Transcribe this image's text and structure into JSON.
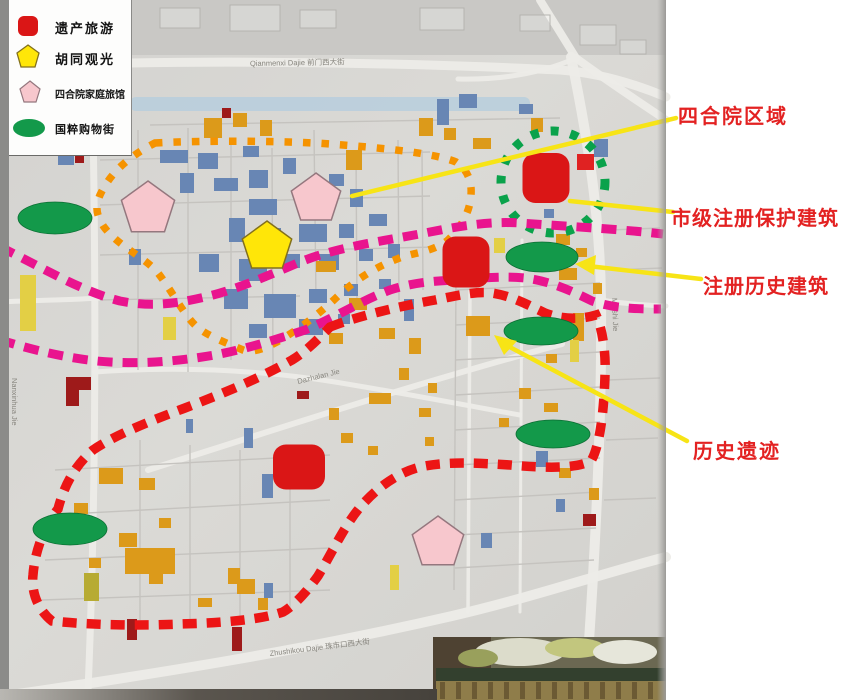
{
  "legend": {
    "items": [
      {
        "label": "遗产旅游",
        "marker": "heritage-red-square"
      },
      {
        "label": "胡同观光",
        "marker": "hutong-yellow-pentagon"
      },
      {
        "label": "四合院家庭旅馆",
        "marker": "courtyard-inn-pink-pentagon"
      },
      {
        "label": "国粹购物街",
        "marker": "shopping-green-ellipse"
      }
    ]
  },
  "colors": {
    "heritage": "#da1616",
    "hutong": "#ffe608",
    "hutong_stroke": "#82701c",
    "inn": "#f7c7cd",
    "inn_stroke": "#94777e",
    "shopping": "#13994a",
    "zone_green": "#0aa24b",
    "zone_orange": "#f59300",
    "boundary_magenta": "#e9148e",
    "route_red": "#ec1515",
    "arrow_yellow": "#f7e416",
    "label_red": "#e32222"
  },
  "annotations": [
    {
      "label": "四合院区域",
      "x": 678,
      "y": 100,
      "line": [
        352,
        196,
        676,
        118
      ]
    },
    {
      "label": "市级注册保护建筑",
      "x": 671,
      "y": 202,
      "line": [
        570,
        201,
        673,
        212
      ]
    },
    {
      "label": "注册历史建筑",
      "x": 703,
      "y": 270,
      "line": [
        588,
        266,
        701,
        279
      ],
      "arrow": [
        [
          575,
          264
        ],
        [
          596,
          255
        ],
        [
          594,
          275
        ]
      ]
    },
    {
      "label": "历史遗迹",
      "x": 693,
      "y": 435,
      "line": [
        504,
        344,
        687,
        441
      ],
      "arrow": [
        [
          494,
          335
        ],
        [
          517,
          341
        ],
        [
          504,
          355
        ]
      ]
    }
  ],
  "map": {
    "street_labels": [
      {
        "text": "Qianmenxi Dajie  前门西大街",
        "x": 250,
        "y": 66,
        "rot": -1
      },
      {
        "text": "Nanxinhua Jie",
        "x": 12,
        "y": 378,
        "rot": 90
      },
      {
        "text": "Dazhalan Jie",
        "x": 298,
        "y": 384,
        "rot": -14
      },
      {
        "text": "Meishi Jie",
        "x": 612,
        "y": 298,
        "rot": 88
      },
      {
        "text": "Zhushikou Dajie  珠市口西大街",
        "x": 270,
        "y": 656,
        "rot": -7
      }
    ],
    "markers": {
      "heritage": [
        {
          "x": 546,
          "y": 178,
          "w": 47,
          "h": 50
        },
        {
          "x": 466,
          "y": 262,
          "w": 47,
          "h": 51
        },
        {
          "x": 299,
          "y": 467,
          "w": 52,
          "h": 45
        }
      ],
      "hutong": [
        {
          "x": 267,
          "y": 247,
          "r": 26
        }
      ],
      "inns": [
        {
          "x": 148,
          "y": 209,
          "r": 28
        },
        {
          "x": 316,
          "y": 199,
          "r": 26
        },
        {
          "x": 438,
          "y": 543,
          "r": 27
        }
      ],
      "shopping": [
        {
          "x": 55,
          "y": 218,
          "rx": 37,
          "ry": 16
        },
        {
          "x": 542,
          "y": 257,
          "rx": 36,
          "ry": 15
        },
        {
          "x": 541,
          "y": 331,
          "rx": 37,
          "ry": 14
        },
        {
          "x": 553,
          "y": 434,
          "rx": 37,
          "ry": 14
        },
        {
          "x": 70,
          "y": 529,
          "rx": 37,
          "ry": 16
        }
      ]
    },
    "zones": {
      "courtyard_circle": {
        "cx": 553,
        "cy": 182,
        "rx": 52,
        "ry": 51
      },
      "orange_loop": "M155,143 C210,140 290,141 330,144 C370,147 432,152 456,162 C468,170 472,182 471,195 C470,212 461,228 447,241 C430,253 414,252 397,259 C371,269 352,283 337,297 C318,315 299,329 277,342 C262,350 250,353 243,350 C227,343 207,336 196,326 C184,315 172,291 158,273 C146,258 118,246 104,227 C96,215 95,207 100,195 C108,178 122,160 155,143 Z",
      "magenta_upper": "M0,247 C40,266 80,291 120,301 C150,307 175,304 205,297 C235,290 265,277 300,262 C340,246 390,240 430,232 C460,226 490,221 520,223 C560,226 620,229 663,234",
      "magenta_lower": "M0,340 C40,352 75,360 110,362 C145,364 180,361 215,355 C245,349 275,340 305,330 C335,318 360,301 390,290 C415,282 435,281 455,280 C480,278 505,276 525,278 C550,281 572,291 592,301 C615,309 640,309 661,309",
      "red_loop": "M330,327 C355,317 400,306 435,300 C455,296 475,291 492,293 C512,296 528,305 545,313 C560,319 580,320 596,315 C603,330 606,355 605,375 C604,410 600,446 591,461 C575,469 545,468 510,465 C478,463 448,461 420,467 C400,472 380,485 362,505 C345,524 332,553 318,576 C308,590 295,605 283,612 C260,620 220,623 180,624 C140,626 90,625 52,621 C38,610 31,592 33,575 C35,550 45,525 58,509 C63,490 72,468 93,450 C115,435 150,421 185,408 C222,394 258,379 292,360 C307,351 320,337 330,327 Z",
      "red_edge_dashes": [
        "M1,30 L6,48",
        "M0,88 L5,104"
      ]
    }
  }
}
